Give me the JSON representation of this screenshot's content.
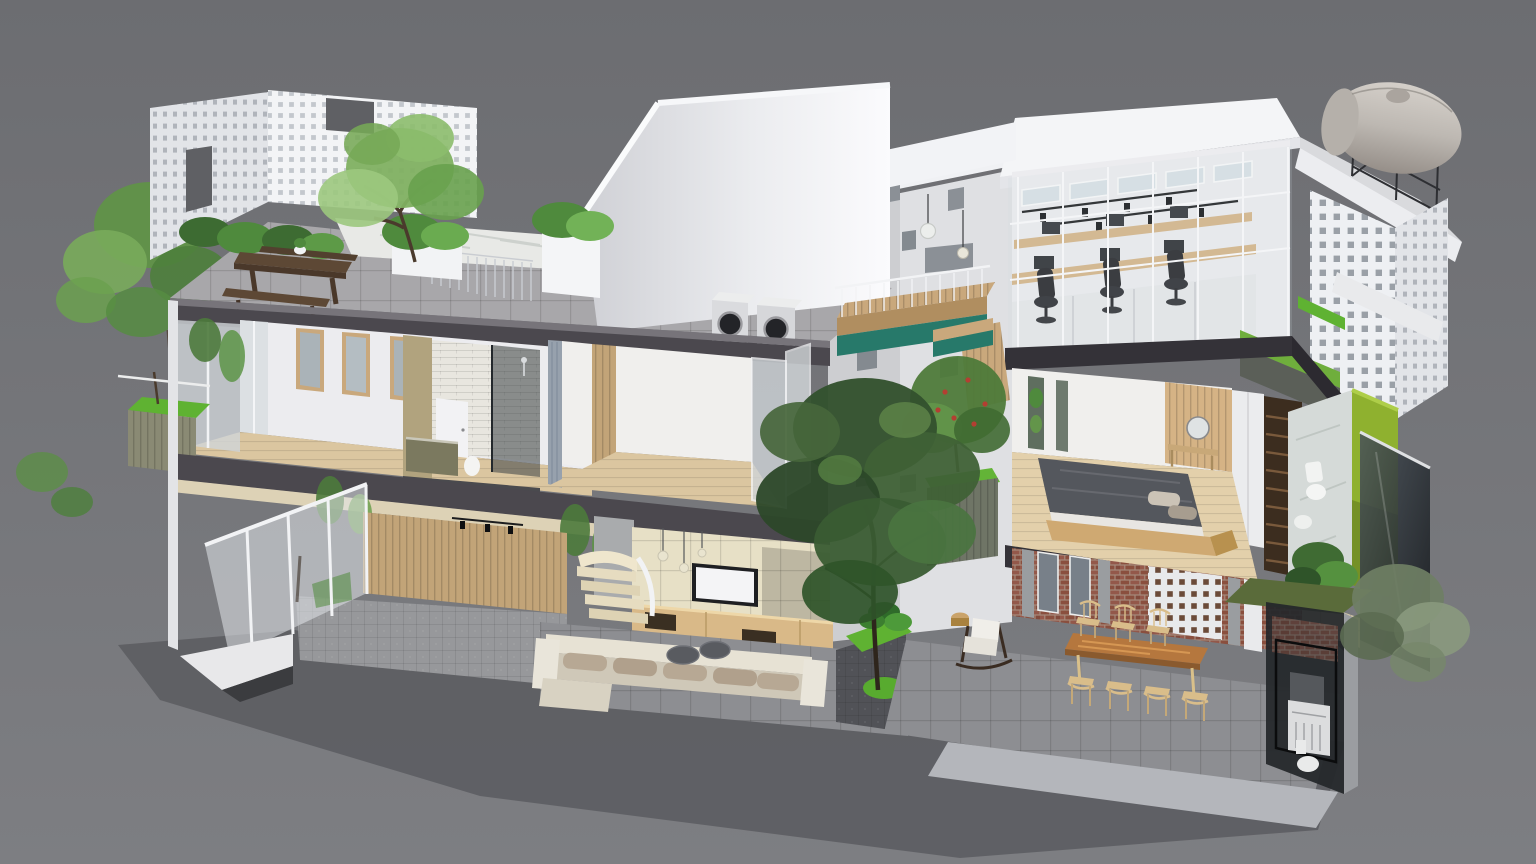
{
  "scene": {
    "description": "Isometric 3D cutaway dollhouse render of a narrow multi-storey tube house with rooftop terrace, office loft, bedrooms, bathrooms, living room, dining courtyard and laundry box, on a plain gray backdrop",
    "view": "three-quarter aerial cutaway, front facade removed",
    "counts": {
      "dining_chairs": 7,
      "office_chairs": 3,
      "roof_washing_machines": 2,
      "pendant_lights_midwall": 3,
      "pendant_lights_living": 3
    }
  },
  "colors": {
    "bg_top": "#6c6d71",
    "bg_bottom": "#7d7e82",
    "apron": "#5e5f63",
    "apron_dark": "#3b3c3f",
    "white_roof": "#f4f5f7",
    "white_wall": "#ececef",
    "white_shaded": "#dfe0e3",
    "white_deep": "#c6c7cb",
    "slab_dark": "#4b484e",
    "slab_deeper": "#343238",
    "deck_gray": "#a8a7aa",
    "paver_gray": "#97989b",
    "tile_floor": "#8d8e92",
    "cobble_dark": "#515257",
    "marble": "#e8e9e6",
    "marble_vein": "#c6cac7",
    "wood_floor": "#dbc6a0",
    "wood_frame": "#c9a87c",
    "wood_slat_wall": "#c2a478",
    "wood_console": "#d9b988",
    "wood_desk": "#d5b385",
    "wood_dark": "#5d4835",
    "wood_table": "#b5773e",
    "wood_table_light": "#d99a55",
    "wood_chair": "#d9bd8a",
    "wood_stair": "#3c2d1f",
    "wood_bed_frame": "#cfa972",
    "green_dark": "#33512e",
    "green_mid": "#4f7a3e",
    "green_light": "#76a957",
    "green_pale": "#9cc87e",
    "grass_bright": "#5fb232",
    "lime_wall": "#8fb12f",
    "moss_roof": "#5a6b3a",
    "gray_green": "#74846a",
    "teal": "#27796a",
    "brick": "#8a4f3e",
    "brick_mortar": "#a5897b",
    "glass_pale": "#cdd4d8",
    "glass_dark": "#343a3e",
    "glass_smoke": "#23272a",
    "curtain": "#97a1ad",
    "duvet": "#54575d",
    "pillow": "#a79d8f",
    "cushion": "#b7a894",
    "sofa_base": "#cfc8b8",
    "sofa_back": "#e7e2d4",
    "black_furniture": "#1f2023",
    "tank_light": "#cdc8c2",
    "tank_dark": "#9d9892",
    "gold_tile": "#b1a37e",
    "olive_cabinet": "#7b795f",
    "cream_tile": "#e7e0c6",
    "cream_step": "#e6dcc0",
    "beige_tile": "#cfc4a8",
    "soffit_cream": "#ddd2b6",
    "metal_gray": "#9b9da1"
  },
  "elements": [
    "gray-backdrop",
    "cut-ground-plane",
    "rooftop-terrace",
    "perforated-breeze-walls",
    "terrace-tree",
    "terrace-planters",
    "picnic-table",
    "skylight-marble-deck",
    "stair-railing",
    "roof-washing-machines",
    "pitched-roof-volume",
    "back-wall-windows",
    "pendant-lights",
    "wood-bridge-balcony",
    "teal-fascia",
    "courtyard-trees",
    "fruit-tree-planter",
    "office-loft",
    "glass-partition",
    "office-desks",
    "monitors",
    "office-chairs",
    "track-lighting",
    "clerestory-windows",
    "water-tank",
    "roof-ramp",
    "green-roof-strips",
    "second-floor-bedroom",
    "window-wall",
    "bathroom-shower",
    "balcony-planter",
    "master-bedroom",
    "platform-bed",
    "vanity-mirror",
    "wardrobe",
    "dark-staircase",
    "green-bathroom",
    "smoked-glass-facade",
    "garage-entry",
    "slat-wall",
    "folding-glass-doors",
    "living-room",
    "tv-wall",
    "tv",
    "media-console",
    "curved-stairs",
    "modular-sofa",
    "coffee-tables",
    "courtyard-garden",
    "rocking-chair",
    "dining-area",
    "brick-wall",
    "breeze-screen",
    "live-edge-dining-table",
    "spindle-chairs",
    "laundry-glass-box",
    "washing-machine",
    "side-trees"
  ]
}
